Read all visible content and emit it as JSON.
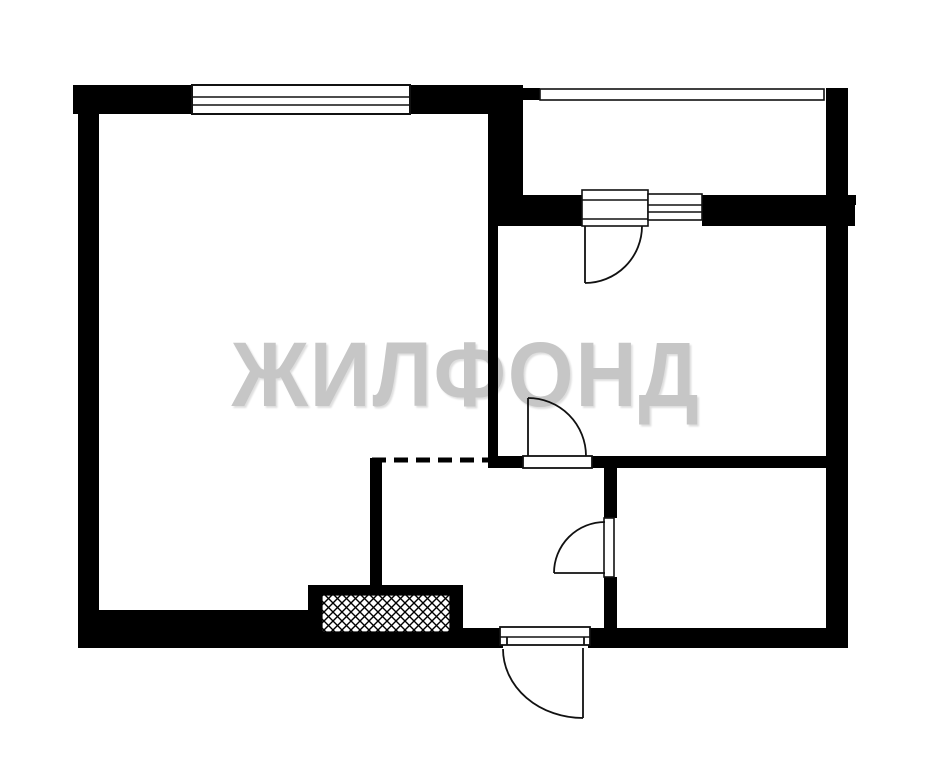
{
  "canvas": {
    "width": 930,
    "height": 768,
    "background": "#ffffff"
  },
  "watermark": {
    "text": "ЖИЛФОНД",
    "color": "#c6c6c6"
  },
  "plan": {
    "wall_color": "#000000",
    "line_color": "#111111",
    "walls": [
      {
        "name": "wall-top-left",
        "x": 73,
        "y": 85,
        "w": 119,
        "h": 29
      },
      {
        "name": "wall-top-right",
        "x": 410,
        "y": 85,
        "w": 113,
        "h": 29
      },
      {
        "name": "wall-left",
        "x": 78,
        "y": 113,
        "w": 21,
        "h": 500
      },
      {
        "name": "wall-bottom-left",
        "x": 78,
        "y": 610,
        "w": 230,
        "h": 38
      },
      {
        "name": "wall-bottom-mid",
        "x": 463,
        "y": 628,
        "w": 40,
        "h": 20
      },
      {
        "name": "wall-bottom-right",
        "x": 588,
        "y": 628,
        "w": 260,
        "h": 20
      },
      {
        "name": "wall-right",
        "x": 826,
        "y": 88,
        "w": 22,
        "h": 560
      },
      {
        "name": "wall-right-nub",
        "x": 848,
        "y": 195,
        "w": 8,
        "h": 10
      },
      {
        "name": "wall-balcony-bottom-a",
        "x": 488,
        "y": 195,
        "w": 94,
        "h": 31
      },
      {
        "name": "wall-balcony-bottom-b",
        "x": 702,
        "y": 195,
        "w": 153,
        "h": 31
      },
      {
        "name": "wall-mid-thick",
        "x": 488,
        "y": 113,
        "w": 35,
        "h": 86
      },
      {
        "name": "wall-mid-thin",
        "x": 488,
        "y": 224,
        "w": 10,
        "h": 232
      },
      {
        "name": "wall-room2-bottom-a",
        "x": 488,
        "y": 456,
        "w": 35,
        "h": 12
      },
      {
        "name": "wall-room2-bottom-b",
        "x": 592,
        "y": 456,
        "w": 236,
        "h": 12
      },
      {
        "name": "wall-hall-top",
        "x": 604,
        "y": 466,
        "w": 13,
        "h": 52
      },
      {
        "name": "wall-hall-bottom",
        "x": 604,
        "y": 577,
        "w": 13,
        "h": 51
      },
      {
        "name": "wall-partition",
        "x": 370,
        "y": 458,
        "w": 12,
        "h": 130
      },
      {
        "name": "wall-balcony-corner",
        "x": 523,
        "y": 88,
        "w": 17,
        "h": 12
      }
    ],
    "vent_shaft": {
      "name": "vent-shaft",
      "outer": {
        "x": 308,
        "y": 585,
        "w": 155,
        "h": 63
      },
      "hatch": {
        "x": 322,
        "y": 595,
        "w": 128,
        "h": 37
      }
    },
    "glazing": [
      {
        "name": "window-living-room",
        "x": 192,
        "y": 85,
        "w": 218,
        "h": 29,
        "stroke": 2,
        "lines": [
          97,
          105
        ]
      },
      {
        "name": "window-balcony-strip",
        "x": 540,
        "y": 89,
        "w": 284,
        "h": 11,
        "stroke": 1.6,
        "lines": []
      },
      {
        "name": "balcony-door-block",
        "x": 582,
        "y": 190,
        "w": 66,
        "h": 36,
        "stroke": 1.6,
        "lines": [
          200,
          219
        ]
      },
      {
        "name": "window-balcony-small",
        "x": 648,
        "y": 194,
        "w": 54,
        "h": 26,
        "stroke": 1.6,
        "lines": [
          205,
          212
        ]
      },
      {
        "name": "door-sill-room2",
        "x": 523,
        "y": 456,
        "w": 69,
        "h": 12,
        "stroke": 1.8,
        "lines": []
      },
      {
        "name": "door-panel-bath",
        "x": 604,
        "y": 518,
        "w": 10,
        "h": 59,
        "stroke": 1.6,
        "lines": []
      },
      {
        "name": "entrance-door-block",
        "x": 500,
        "y": 627,
        "w": 90,
        "h": 18,
        "stroke": 1.8,
        "lines": [
          637
        ]
      }
    ],
    "door_swings": [
      {
        "name": "door-balcony",
        "paths": [
          "M585 226 L585 283",
          "M585 283 A57 57 0 0 0 642 226"
        ]
      },
      {
        "name": "door-room2",
        "paths": [
          "M528 456 L528 398",
          "M528 398 A58 58 0 0 1 586 456"
        ]
      },
      {
        "name": "door-bathroom",
        "paths": [
          "M605 573 L554 573",
          "M554 573 A51 51 0 0 1 605 522"
        ]
      },
      {
        "name": "door-entrance",
        "paths": [
          "M583 648 L583 718",
          "M503 649 A80 69 0 0 0 583 718",
          "M507 637 L507 645",
          "M584 637 L584 645"
        ]
      }
    ],
    "dashed_boundary": {
      "name": "dashed-opening",
      "x1": 372,
      "y1": 460,
      "x2": 488,
      "y2": 460,
      "width": 5,
      "dash": "14 8"
    }
  }
}
